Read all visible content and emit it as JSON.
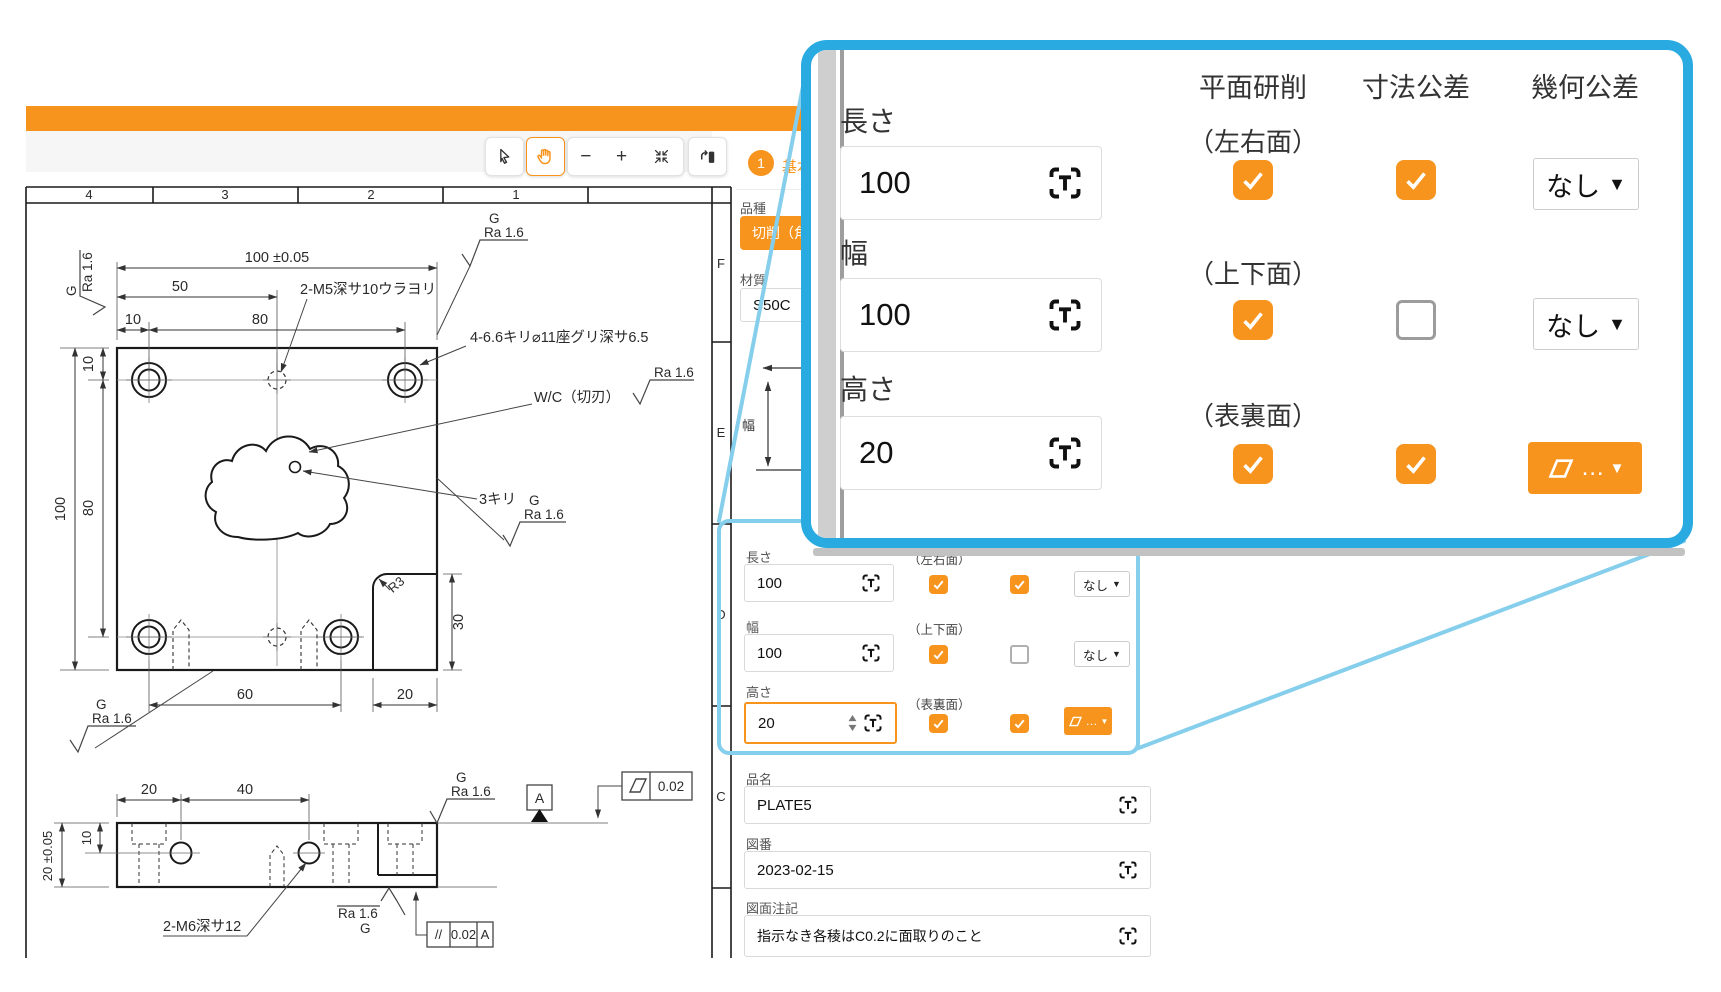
{
  "stepper": {
    "number": "1",
    "label": "基本情報"
  },
  "form": {
    "category_label": "品種",
    "category_value": "切削（角物）",
    "material_label": "材質",
    "material_value": "S50C",
    "sketch_label": "幅",
    "col_headers": {
      "grinding": "平面研削",
      "tolerance": "寸法公差",
      "geometric": "幾何公差"
    },
    "rows": [
      {
        "label": "長さ",
        "value": "100",
        "face": "（左右面）",
        "grinding": true,
        "tolerance": true,
        "geometric": "なし"
      },
      {
        "label": "幅",
        "value": "100",
        "face": "（上下面）",
        "grinding": true,
        "tolerance": false,
        "geometric": "なし"
      },
      {
        "label": "高さ",
        "value": "20",
        "face": "（表裏面）",
        "grinding": true,
        "tolerance": true,
        "geometric": "…",
        "geometric_icon": "parallelogram"
      }
    ],
    "product_name_label": "品名",
    "product_name": "PLATE5",
    "drawing_no_label": "図番",
    "drawing_no": "2023-02-15",
    "note_label": "図面注記",
    "note": "指示なき各稜はC0.2に面取りのこと"
  },
  "drawing": {
    "zones_top": [
      "4",
      "3",
      "2",
      "1"
    ],
    "zones_right": [
      "F",
      "E",
      "D",
      "C"
    ],
    "labels": {
      "dim_width_top": "100 ±0.05",
      "dim_50": "50",
      "dim_10_top": "10",
      "dim_80_top": "80",
      "dim_100_left": "100",
      "dim_80_left": "80",
      "dim_10_left": "10",
      "dim_30_right": "30",
      "dim_60_bottom": "60",
      "dim_20_bottom": "20",
      "callout_m5": "2-M5深サ10ウラヨリ",
      "callout_counterbore": "4-6.6キリ⌀11座グリ深サ6.5",
      "callout_wc": "W/C（切刃）",
      "callout_3kiri": "3キリ",
      "fillet_r3": "R3",
      "callout_m6": "2-M6深サ12",
      "sv_dim_20": "20",
      "sv_dim_40": "40",
      "sv_dim_10": "10",
      "sv_dim_20t": "20 ±0.05",
      "surface_g": "G",
      "surface_ra": "Ra 1.6",
      "datum_a": "A",
      "flatness_value": "0.02",
      "parallelism_symbol": "//",
      "parallelism_value": "0.02",
      "parallelism_datum": "A"
    }
  },
  "icons": {
    "dropdown_arrow": "▼",
    "geo_ellipsis": "…",
    "minus": "−",
    "plus": "+"
  },
  "colors": {
    "accent": "#F7941E",
    "magnifier_border": "#29ABE2",
    "leader": "#85CEEC"
  }
}
